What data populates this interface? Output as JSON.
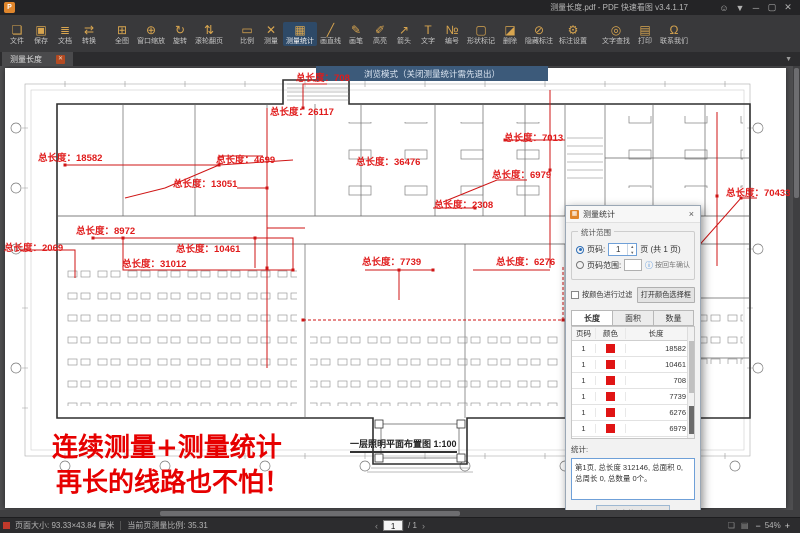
{
  "window": {
    "title": "测量长度.pdf - PDF 快速看图 v3.4.1.17",
    "logo_glyph": "P",
    "controls": {
      "user": "☺",
      "skin": "▼",
      "minimize": "─",
      "maximize": "▢",
      "close": "✕"
    }
  },
  "toolbar": {
    "groups": [
      {
        "items": [
          {
            "label": "文件",
            "icon": "❏"
          },
          {
            "label": "保存",
            "icon": "▣"
          },
          {
            "label": "文档",
            "icon": "≣"
          },
          {
            "label": "转换",
            "icon": "⇄"
          }
        ]
      },
      {
        "items": [
          {
            "label": "全图",
            "icon": "⊞"
          },
          {
            "label": "窗口缩放",
            "icon": "⊕"
          },
          {
            "label": "旋转",
            "icon": "↻"
          },
          {
            "label": "滚轮翻页",
            "icon": "⇅"
          }
        ]
      },
      {
        "items": [
          {
            "label": "比例",
            "icon": "▭"
          },
          {
            "label": "测量",
            "icon": "✕"
          },
          {
            "label": "测量统计",
            "icon": "▦"
          },
          {
            "label": "画直线",
            "icon": "╱"
          },
          {
            "label": "画笔",
            "icon": "✎"
          },
          {
            "label": "高亮",
            "icon": "✐"
          },
          {
            "label": "箭头",
            "icon": "↗"
          },
          {
            "label": "文字",
            "icon": "T"
          },
          {
            "label": "编号",
            "icon": "№"
          },
          {
            "label": "形状标记",
            "icon": "▢"
          },
          {
            "label": "删除",
            "icon": "◪"
          },
          {
            "label": "隐藏标注",
            "icon": "⊘"
          },
          {
            "label": "标注设置",
            "icon": "⚙"
          }
        ]
      },
      {
        "items": [
          {
            "label": "文字查找",
            "icon": "◎"
          },
          {
            "label": "打印",
            "icon": "▤"
          },
          {
            "label": "联系我们",
            "icon": "Ω"
          }
        ]
      }
    ]
  },
  "tabbar": {
    "tab": "测量长度",
    "close": "✕",
    "collapse": "▼"
  },
  "banner": {
    "text": "浏览模式（关闭测量统计需先退出）"
  },
  "canvas": {
    "caption": "一层照明平面布置图 1:100",
    "slogan_line1": "连续测量+测量统计",
    "slogan_line2": "再长的线路也不怕！",
    "axis_label_d": "D",
    "measure_color": "#e01b1b",
    "measure_labels": [
      {
        "text": "总长度：18582"
      },
      {
        "text": "总长度：4699"
      },
      {
        "text": "总长度：708"
      },
      {
        "text": "总长度：26117"
      },
      {
        "text": "总长度：36476"
      },
      {
        "text": "总长度：13051"
      },
      {
        "text": "总长度：8972"
      },
      {
        "text": "总长度：2069"
      },
      {
        "text": "总长度：31012"
      },
      {
        "text": "总长度：10461"
      },
      {
        "text": "总长度：7739"
      },
      {
        "text": "总长度：6276"
      },
      {
        "text": "总长度：6979"
      },
      {
        "text": "总长度：7013"
      },
      {
        "text": "总长度：2308"
      },
      {
        "text": "总长度：70433"
      }
    ]
  },
  "panel": {
    "title": "测量统计",
    "icon": "▦",
    "close": "×",
    "range_group": {
      "title": "统计范围",
      "radio_page": "页码:",
      "page_value": "1",
      "page_suffix": "页 (共 1 页)",
      "radio_range": "页码范围:",
      "info": "ⓘ",
      "range_hint": "按回车确认"
    },
    "filter": {
      "checkbox": "按颜色进行过滤",
      "button": "打开颜色选择框"
    },
    "tabs": [
      {
        "label": "长度"
      },
      {
        "label": "面积"
      },
      {
        "label": "数量"
      }
    ],
    "table": {
      "headers": [
        "页码",
        "颜色",
        "长度"
      ],
      "swatch_color": "#e01414",
      "rows": [
        {
          "page": "1",
          "length": "18582"
        },
        {
          "page": "1",
          "length": "10461"
        },
        {
          "page": "1",
          "length": "708"
        },
        {
          "page": "1",
          "length": "7739"
        },
        {
          "page": "1",
          "length": "6276"
        },
        {
          "page": "1",
          "length": "6979"
        }
      ]
    },
    "total_label": "统计:",
    "summary": "第1页, 总长度 312146, 总面积 0, 总周长 0, 总数量 0个。",
    "export_button": "导出表格到Excel"
  },
  "statusbar": {
    "page_size": "页面大小: 93.33×43.84 厘米",
    "scale": "当前页测量比例: 35.31",
    "prev": "‹",
    "page": "1",
    "total": "/ 1",
    "next": "›",
    "layout_icon1": "❏",
    "layout_icon2": "▤",
    "zoom_out": "−",
    "zoom": "54%",
    "zoom_in": "+"
  }
}
